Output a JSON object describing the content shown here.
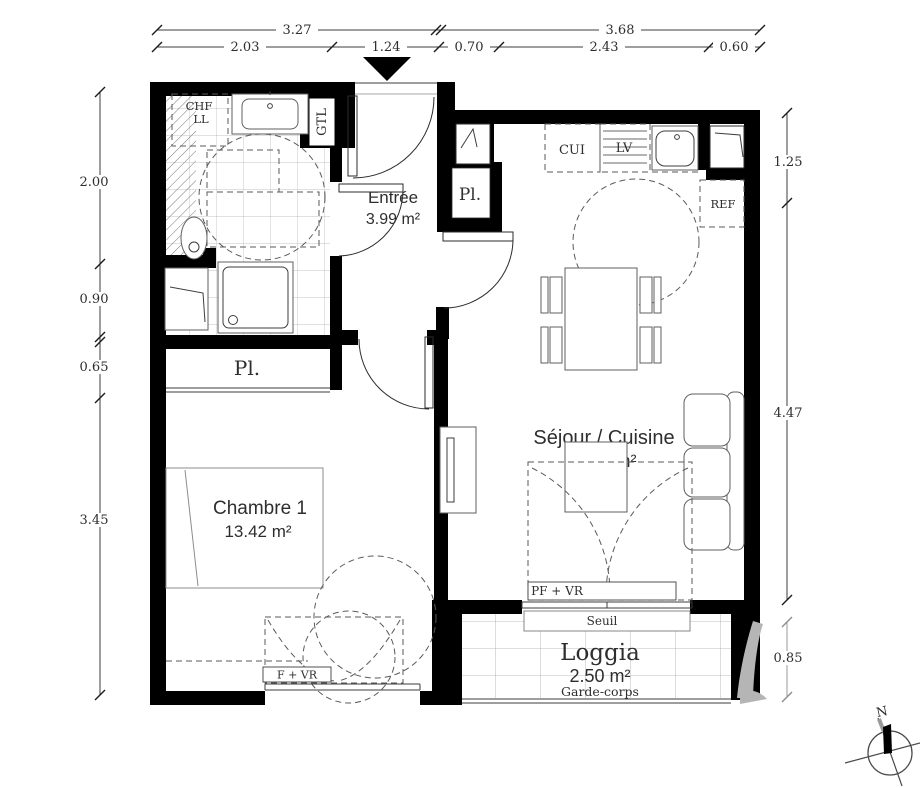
{
  "plan": {
    "type": "apartment-floor-plan",
    "north_label": "N"
  },
  "dimensions": {
    "top_upper": [
      "3.27",
      "3.68"
    ],
    "top_lower": [
      "2.03",
      "1.24",
      "0.70",
      "2.43",
      "0.60"
    ],
    "left": [
      "2.00",
      "0.90",
      "0.65",
      "3.45"
    ],
    "right": [
      "1.25",
      "4.47",
      "0.85"
    ]
  },
  "rooms": {
    "entree": {
      "name": "Entrée",
      "area": "3.99 m²"
    },
    "sejour": {
      "name": "Séjour / Cuisine",
      "area": "19.57 m²"
    },
    "chambre": {
      "name": "Chambre 1",
      "area": "13.42 m²"
    },
    "loggia": {
      "name": "Loggia",
      "area": "2.50 m²"
    }
  },
  "labels": {
    "chf": "CHF",
    "ll": "LL",
    "gtl": "GTL",
    "pl_entree": "Pl.",
    "pl_chambre": "Pl.",
    "cui": "CUI",
    "lv": "LV",
    "ref": "REF",
    "pf_vr": "PF + VR",
    "seuil": "Seuil",
    "garde_corps": "Garde-corps",
    "f_vr": "F + VR"
  },
  "colors": {
    "wall": "#000000",
    "line": "#3d3d3d",
    "dashed": "#5a5a5a",
    "tile": "#b0b0b0",
    "watermark": "#b5b5b5",
    "text": "#383838"
  }
}
